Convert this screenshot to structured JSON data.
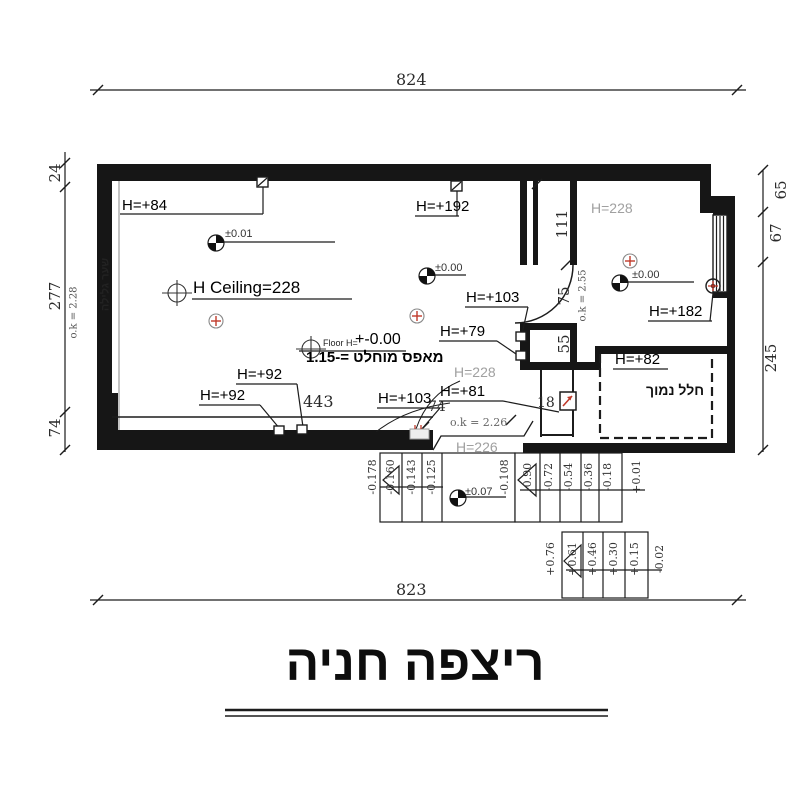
{
  "title": "ריצפה חניה",
  "dims": {
    "top": "824",
    "bottom": "823",
    "left24": "24",
    "left277": "277",
    "leftOk": "o.k = 2.28",
    "left74": "74",
    "right65": "65",
    "right67": "67",
    "right245": "245",
    "d111": "111",
    "d75": "75",
    "ok255": "o.k = 2.55",
    "d55": "55",
    "d443": "443",
    "d74": "74",
    "d18": "18",
    "ok226": "o.k = 2.26"
  },
  "heights": {
    "h84": "H=+84",
    "h192": "H=+192",
    "ceiling": "H Ceiling=228",
    "h103Right": "H=+103",
    "h79": "H=+79",
    "h92Upper": "H=+92",
    "h92Lower": "H=+92",
    "h103Bottom": "H=+103",
    "h81": "H=+81",
    "h182": "H=+182",
    "h82": "H=+82",
    "room228": "H=228",
    "mid228": "H=228",
    "mid226": "H=226"
  },
  "floor": {
    "prefix": "Floor H=",
    "value": "+-0.00",
    "absolute": "מאפס מוחלט =-1.15"
  },
  "rooms": {
    "lowSpace": "חלל נמוך",
    "rollingGate": "שער גלילה"
  },
  "survey": {
    "p001": "±0.01",
    "p000Main": "±0.00",
    "p000Room": "±0.00",
    "p007": "±0.07"
  },
  "stairs": {
    "ramp": [
      "-0.178",
      "-0.160",
      "-0.143",
      "-0.125",
      "-0.108"
    ],
    "upper": [
      "-0.90",
      "-0.72",
      "-0.54",
      "-0.36",
      "-0.18"
    ],
    "upperEnd": "+0.01",
    "lowerStart": "+0.76",
    "lower": [
      "+0.61",
      "+0.46",
      "+0.30",
      "+0.15"
    ],
    "lowerEnd": "-0.02"
  },
  "colors": {
    "ink": "#1c1c1c",
    "muted": "#9e9e9e",
    "red": "#c03a2b"
  }
}
